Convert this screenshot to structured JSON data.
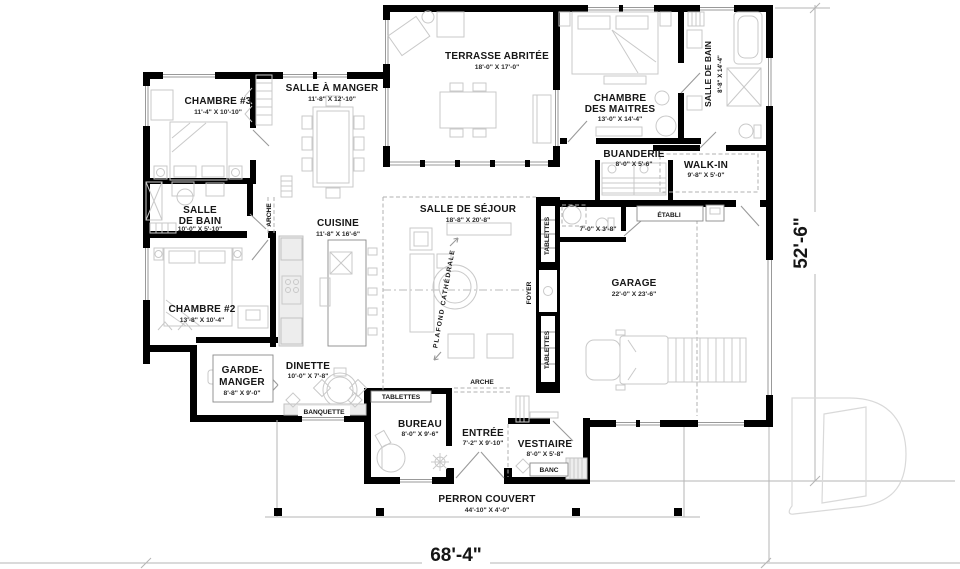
{
  "page": {
    "background": "#ffffff"
  },
  "plan": {
    "overall_width": "68'-4\"",
    "overall_depth": "52'-6\"",
    "rooms": {
      "chambre3": {
        "name": "CHAMBRE #3",
        "dims": "11'-4\" X 10'-10\""
      },
      "salle_a_manger": {
        "name": "SALLE À MANGER",
        "dims": "11'-8\" X 12'-10\""
      },
      "terrasse": {
        "name": "TERRASSE ABRITÉE",
        "dims": "18'-0\" X 17'-0\""
      },
      "maitres": {
        "name1": "CHAMBRE",
        "name2": "DES MAITRES",
        "dims": "13'-0\" X 14'-4\""
      },
      "bain_maitres": {
        "name": "SALLE DE BAIN",
        "dims": "8'-8\" X 14'-4\""
      },
      "buanderie": {
        "name": "BUANDERIE",
        "dims": "8'-0\" X 5'-6\""
      },
      "walkin": {
        "name": "WALK-IN",
        "dims": "9'-8\" X 5'-0\""
      },
      "bain2": {
        "name1": "SALLE",
        "name2": "DE BAIN",
        "dims": "10'-0\" X 5'-10\""
      },
      "cuisine": {
        "name": "CUISINE",
        "dims": "11'-8\" X 16'-6\""
      },
      "sejour": {
        "name": "SALLE DE SÉJOUR",
        "dims": "18'-8\" X 20'-8\""
      },
      "garage": {
        "name": "GARAGE",
        "dims": "22'-0\" X 23'-6\""
      },
      "chambre2": {
        "name": "CHAMBRE #2",
        "dims": "13'-8\" X 10'-4\""
      },
      "garde_manger": {
        "name1": "GARDE-",
        "name2": "MANGER",
        "dims": "8'-8\" X 9'-0\""
      },
      "dinette": {
        "name": "DINETTE",
        "dims": "10'-0\" X 7'-8\""
      },
      "bureau": {
        "name": "BUREAU",
        "dims": "8'-0\" X 9'-6\""
      },
      "entree": {
        "name": "ENTRÉE",
        "dims": "7'-2\" X 9'-10\""
      },
      "vestiaire": {
        "name": "VESTIAIRE",
        "dims": "8'-0\" X 5'-8\""
      },
      "perron": {
        "name": "PERRON COUVERT",
        "dims": "44'-10\" X 4'-0\""
      },
      "salle_eau": {
        "dims": "7'-0\" X 3'-8\""
      }
    },
    "annotations": {
      "arche_hall": "ARCHE",
      "arche_sejour": "ARCHE",
      "tablettes_haut": "TABLETTES",
      "tablettes_bas": "TABLETTES",
      "tablettes_bureau": "TABLETTES",
      "foyer": "FOYER",
      "plafond_cathedrale": "PLAFOND CATHÉDRALE",
      "etabli": "ÉTABLI",
      "banquette": "BANQUETTE",
      "banc": "BANC"
    },
    "colors": {
      "wall": "#000000",
      "furniture": "#c9c9c9",
      "dimension_line": "#b5b5b5",
      "watermark": "#d9d9d9"
    }
  }
}
